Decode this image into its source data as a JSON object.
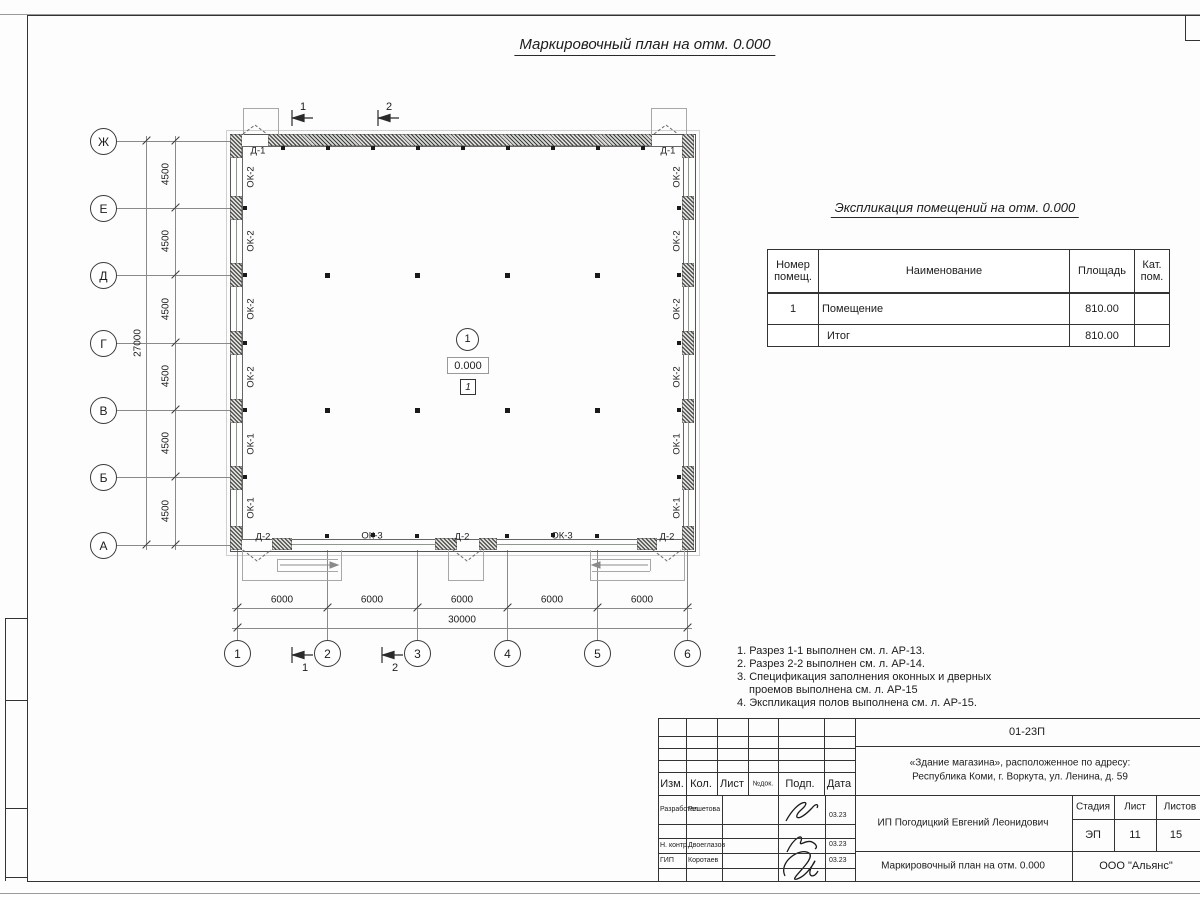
{
  "sheet_title": "Маркировочный план на отм. 0.000",
  "plan": {
    "row_axes": [
      "Ж",
      "Е",
      "Д",
      "Г",
      "В",
      "Б",
      "А"
    ],
    "col_axes": [
      "1",
      "2",
      "3",
      "4",
      "5",
      "6"
    ],
    "row_dims": [
      "4500",
      "4500",
      "4500",
      "4500",
      "4500",
      "4500"
    ],
    "row_total": "27000",
    "col_dims": [
      "6000",
      "6000",
      "6000",
      "6000",
      "6000"
    ],
    "col_total": "30000",
    "left_wall_marks": [
      "ОК-2",
      "ОК-2",
      "ОК-2",
      "ОК-2",
      "ОК-1",
      "ОК-1"
    ],
    "right_wall_marks": [
      "ОК-2",
      "ОК-2",
      "ОК-2",
      "ОК-2",
      "ОК-1",
      "ОК-1"
    ],
    "top_door_marks": [
      "Д-1",
      "Д-1"
    ],
    "bottom_marks": [
      "Д-2",
      "ОК-3",
      "Д-2",
      "ОК-3",
      "Д-2"
    ],
    "section_marks": [
      "1",
      "2"
    ],
    "room": {
      "number": "1",
      "elevation": "0.000",
      "floor_type": "1"
    }
  },
  "expl_table": {
    "title": "Экспликация помещений на отм. 0.000",
    "headers": [
      "Номер помещ.",
      "Наименование",
      "Площадь",
      "Кат. пом."
    ],
    "rows": [
      {
        "num": "1",
        "name": "Помещение",
        "area": "810.00",
        "cat": ""
      },
      {
        "num": "",
        "name": "Итог",
        "area": "810.00",
        "cat": ""
      }
    ]
  },
  "notes": [
    "1. Разрез 1-1 выполнен см. л. АР-13.",
    "2. Разрез 2-2 выполнен см. л. АР-14.",
    "3. Спецификация заполнения оконных и дверных",
    "проемов выполнена см. л. АР-15",
    "4. Экспликация полов выполнена см. л. АР-15."
  ],
  "stamp": {
    "doc_number": "01-23П",
    "object_line1": "«Здание магазина», расположенное по адресу:",
    "object_line2": "Республика Коми, г. Воркута, ул. Ленина, д. 59",
    "header_cols": [
      "Изм.",
      "Кол.",
      "Лист",
      "№док.",
      "Подп.",
      "Дата"
    ],
    "rows": [
      {
        "role": "Разработал",
        "name": "Решетова",
        "date": "03.23"
      },
      {
        "role": "Н. контр.",
        "name": "Двоеглазов",
        "date": "03.23"
      },
      {
        "role": "ГИП",
        "name": "Коротаев",
        "date": "03.23"
      }
    ],
    "client": "ИП Погодицкий Евгений Леонидович",
    "stage_label": "Стадия",
    "sheet_label": "Лист",
    "sheets_label": "Листов",
    "stage": "ЭП",
    "sheet": "11",
    "sheets": "15",
    "drawing_name": "Маркировочный план на отм. 0.000",
    "company": "ООО \"Альянс\""
  }
}
